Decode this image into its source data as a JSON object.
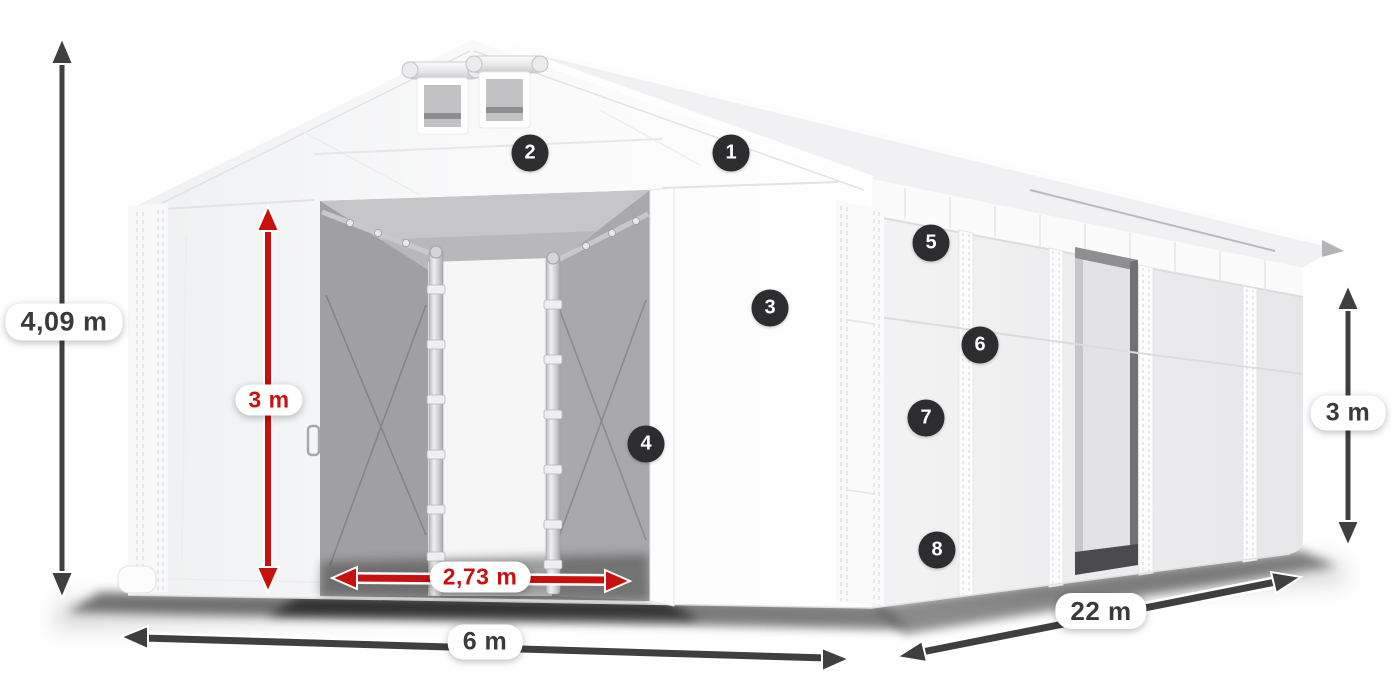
{
  "diagram": {
    "subject": "storage-tent-dimension-diagram",
    "background": "#ffffff",
    "colors": {
      "red_accent": "#c8100e",
      "gray_arrow": "#3e3f40",
      "marker_bg": "#2d2d2f",
      "marker_text": "#ffffff",
      "label_text": "#3a3a3b",
      "tent_white": "#f7f7f8",
      "interior_gray": "#a3a3a5"
    },
    "dimensions": {
      "total_height": "4,09 m",
      "front_door_height": "3 m",
      "front_door_width": "2,73 m",
      "front_width": "6 m",
      "length": "22 m",
      "side_wall_height": "3 m"
    }
  },
  "markers": [
    {
      "label": "1",
      "x": 731,
      "y": 153
    },
    {
      "label": "2",
      "x": 530,
      "y": 153
    },
    {
      "label": "3",
      "x": 770,
      "y": 308
    },
    {
      "label": "4",
      "x": 646,
      "y": 444
    },
    {
      "label": "5",
      "x": 931,
      "y": 243
    },
    {
      "label": "6",
      "x": 980,
      "y": 345
    },
    {
      "label": "7",
      "x": 926,
      "y": 418
    },
    {
      "label": "8",
      "x": 937,
      "y": 550
    }
  ]
}
